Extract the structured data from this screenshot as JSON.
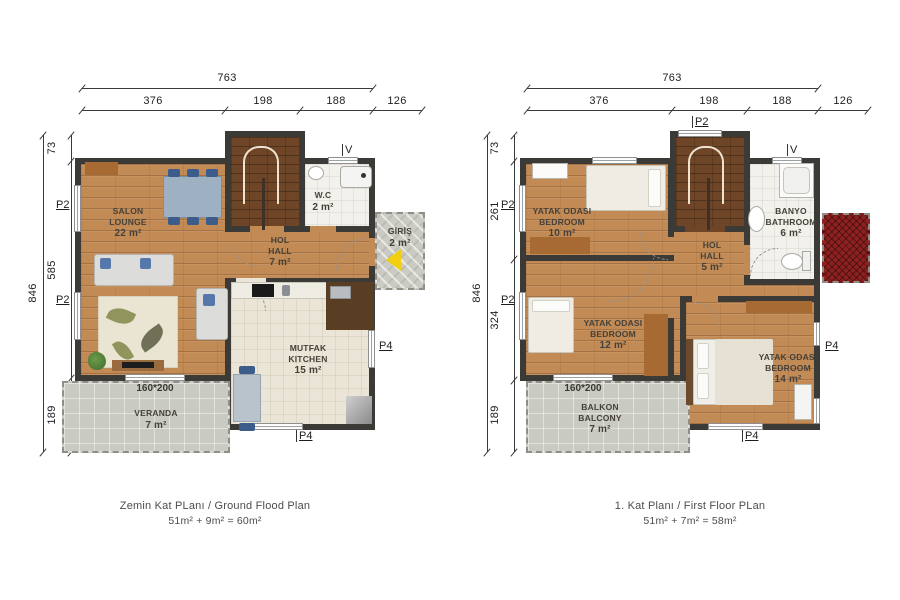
{
  "colors": {
    "wall": "#3b3a36",
    "wood_floor": "#c28a55",
    "stair_wood": "#6e4526",
    "kitchen_tile": "#eae5d6",
    "bath_tile": "#f2f1ec",
    "outdoor_concrete": "#c9cbc2",
    "roof_red": "#8e2020",
    "entrance_arrow_yellow": "#f2cf0e",
    "chair_navy": "#3c5c8c",
    "furniture_brown": "#a86a33"
  },
  "markers": {
    "p2": "P2",
    "p4": "P4",
    "v": "V",
    "window_size": "160*200"
  },
  "plans": [
    {
      "name": "ground-floor",
      "top_dims": {
        "total": "763",
        "segments": [
          "376",
          "198",
          "188",
          "126"
        ]
      },
      "side_dims": {
        "total": "846",
        "segments": [
          "73",
          "585",
          "189"
        ]
      },
      "rooms": {
        "salon": {
          "line1": "SALON",
          "line2": "LOUNGE",
          "area": "22 m²"
        },
        "hall": {
          "line1": "HOL",
          "line2": "HALL",
          "area": "7 m²"
        },
        "wc": {
          "line1": "W.C",
          "area": "2 m²"
        },
        "giris": {
          "line1": "GİRİŞ",
          "area": "2 m²"
        },
        "kitchen": {
          "line1": "MUTFAK",
          "line2": "KITCHEN",
          "area": "15 m²"
        },
        "veranda": {
          "line1": "VERANDA",
          "area": "7 m²"
        }
      },
      "caption": {
        "title": "Zemin Kat PLanı / Ground Flood Plan",
        "formula": "51m² + 9m² = 60m²"
      }
    },
    {
      "name": "first-floor",
      "top_dims": {
        "total": "763",
        "segments": [
          "376",
          "198",
          "188",
          "126"
        ]
      },
      "side_dims": {
        "total": "846",
        "segments": [
          "73",
          "261",
          "324",
          "189"
        ]
      },
      "rooms": {
        "bedroom1": {
          "line1": "YATAK ODASI",
          "line2": "BEDROOM",
          "area": "10 m²"
        },
        "hall": {
          "line1": "HOL",
          "line2": "HALL",
          "area": "5 m²"
        },
        "bath": {
          "line1": "BANYO",
          "line2": "BATHROOM",
          "area": "6 m²"
        },
        "bedroom2": {
          "line1": "YATAK ODASI",
          "line2": "BEDROOM",
          "area": "12 m²"
        },
        "bedroom3": {
          "line1": "YATAK ODASI",
          "line2": "BEDROOM",
          "area": "14 m²"
        },
        "balcony": {
          "line1": "BALKON",
          "line2": "BALCONY",
          "area": "7 m²"
        }
      },
      "caption": {
        "title": "1. Kat Planı / First Floor PLan",
        "formula": "51m² + 7m² = 58m²"
      }
    }
  ]
}
